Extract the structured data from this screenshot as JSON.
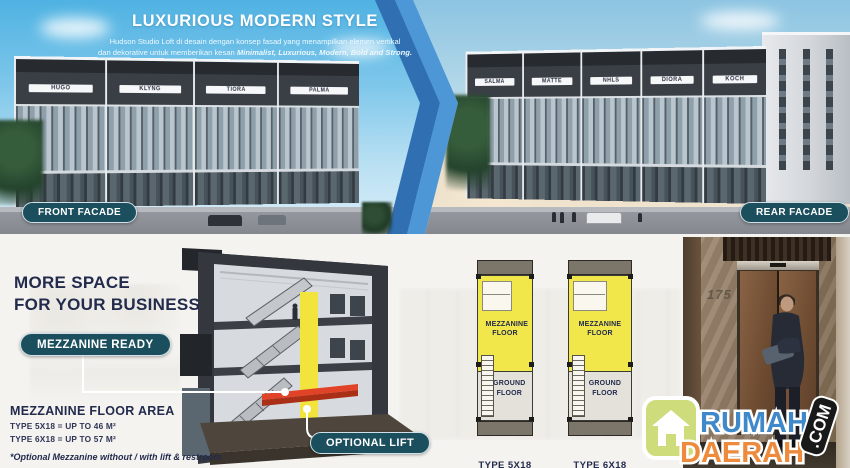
{
  "top": {
    "title": "LUXURIOUS MODERN STYLE",
    "desc_line1": "Hudson Studio Loft di desain dengan konsep fasad yang menampilkan elemen vertikal",
    "desc_line2_prefix": "dan dekorative untuk memberikan kesan ",
    "desc_line2_bold": "Minimalist, Luxurious, Modern, Bold and Strong.",
    "front_facade_label": "FRONT FACADE",
    "rear_facade_label": "REAR FACADE",
    "front_building_signs": [
      "HUGO",
      "KLYNG",
      "TIORA",
      "PALMA"
    ],
    "rear_building_signs": [
      "SALMA",
      "MATTE",
      "NHLS",
      "DIORA",
      "KOCH"
    ]
  },
  "bottom": {
    "headline_line1": "MORE SPACE",
    "headline_line2": "FOR YOUR BUSINESS",
    "mezzanine_ready_label": "MEZZANINE READY",
    "optional_lift_label": "OPTIONAL LIFT",
    "floor_area": {
      "title": "MEZZANINE FLOOR AREA",
      "row1": "TYPE 5X18 = UP TO 46 M²",
      "row2": "TYPE 6X18 = UP TO 57 M²",
      "note": "*Optional Mezzanine without / with lift & restroom"
    },
    "plans": [
      {
        "mezzanine_label": "MEZZANINE FLOOR",
        "ground_label": "GROUND FLOOR",
        "type_label": "TYPE 5X18"
      },
      {
        "mezzanine_label": "MEZZANINE FLOOR",
        "ground_label": "GROUND FLOOR",
        "type_label": "TYPE 6X18"
      }
    ],
    "elevator_number": "175"
  },
  "logo": {
    "word1": "RUMAH",
    "word2": "DAERAH",
    "suffix": ".COM"
  },
  "colors": {
    "pill_teal": "#1b4f5e",
    "navy": "#232b4d",
    "plan_yellow": "#f1e74b",
    "mezzanine_red": "#e04327",
    "chevron_dark_blue": "#2f6fb2",
    "chevron_light_blue": "#4d97d6",
    "logo_blue": "#3f88c9",
    "logo_orange": "#ee8a3c"
  }
}
